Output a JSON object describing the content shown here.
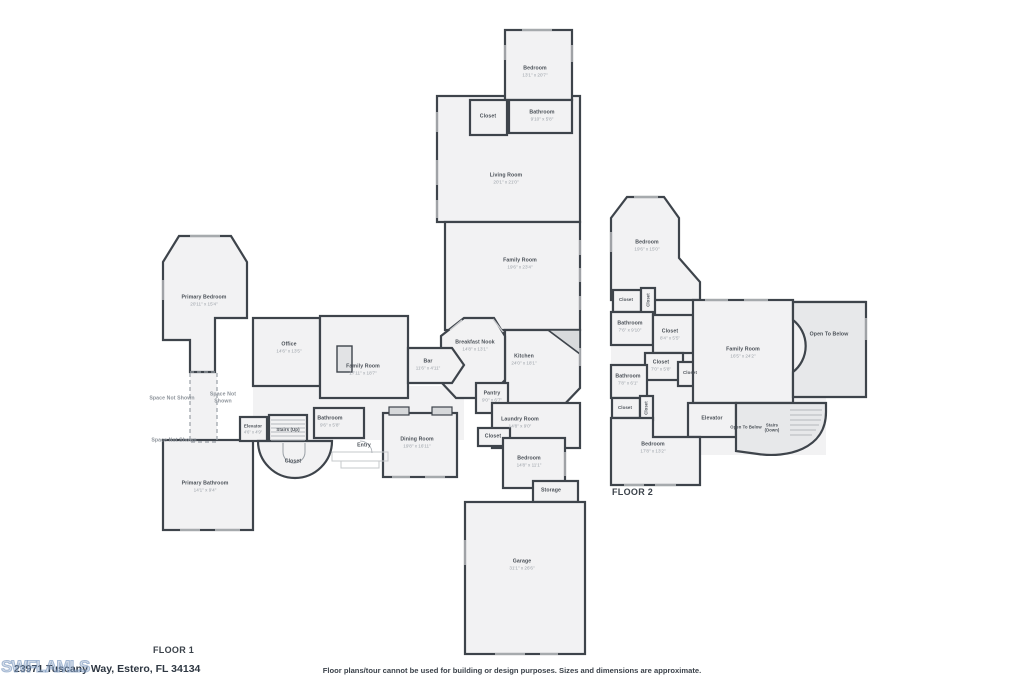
{
  "footer": {
    "address": "23971 Tuscany Way, Estero, FL 34134",
    "disclaimer": "Floor plans/tour cannot be used for building or design purposes. Sizes and dimensions are approximate.",
    "watermark": "SWFLAMLS"
  },
  "colors": {
    "wall": "#3e444b",
    "room_fill": "#f2f2f3",
    "shaded_fill": "#e7e8ea",
    "name_text": "#4a5057",
    "dim_text": "#9ba1a8"
  },
  "floor1": {
    "label": "FLOOR 1",
    "rooms": {
      "bedroom_top": {
        "name": "Bedroom",
        "dims": "13'1\" x 20'7\""
      },
      "closet_top": {
        "name": "Closet"
      },
      "bathroom_top": {
        "name": "Bathroom",
        "dims": "9'10\" x 5'8\""
      },
      "living_room": {
        "name": "Living Room",
        "dims": "20'1\" x 21'0\""
      },
      "family_room": {
        "name": "Family Room",
        "dims": "19'6\" x 23'4\""
      },
      "primary_bedroom": {
        "name": "Primary Bedroom",
        "dims": "20'11\" x 15'4\""
      },
      "office": {
        "name": "Office",
        "dims": "14'6\" x 13'5\""
      },
      "family_room_left": {
        "name": "Family Room",
        "dims": "17'11\" x 18'7\""
      },
      "bar": {
        "name": "Bar",
        "dims": "11'6\" x 4'11\""
      },
      "breakfast_nook": {
        "name": "Breakfast Nook",
        "dims": "14'8\" x 13'1\""
      },
      "kitchen": {
        "name": "Kitchen",
        "dims": "24'0\" x 18'1\""
      },
      "pantry": {
        "name": "Pantry",
        "dims": "9'0\" x 6'7\""
      },
      "laundry_room": {
        "name": "Laundry Room",
        "dims": "14'8\" x 9'0\""
      },
      "closet_hall": {
        "name": "Closet"
      },
      "bedroom_guest": {
        "name": "Bedroom",
        "dims": "14'8\" x 11'1\""
      },
      "storage": {
        "name": "Storage"
      },
      "garage": {
        "name": "Garage",
        "dims": "31'1\" x 26'6\""
      },
      "dining_room": {
        "name": "Dining Room",
        "dims": "19'8\" x 16'11\""
      },
      "bathroom_hall": {
        "name": "Bathroom",
        "dims": "9'6\" x 5'8\""
      },
      "entry": {
        "name": "Entry"
      },
      "elevator": {
        "name": "Elevator",
        "dims": "4'6\" x 4'9\""
      },
      "stairs_up": {
        "name": "Stairs (Up)"
      },
      "closet_stairs": {
        "name": "Closet"
      },
      "space_not_shown_a": {
        "name": "Space Not Shown"
      },
      "space_not_shown_b": {
        "name": "Space Not Shown"
      },
      "space_not_shown_c": {
        "name": "Space Not Shown"
      },
      "primary_bathroom": {
        "name": "Primary Bathroom",
        "dims": "14'1\" x 9'4\""
      }
    }
  },
  "floor2": {
    "label": "FLOOR 2",
    "rooms": {
      "bedroom": {
        "name": "Bedroom",
        "dims": "19'6\" x 15'0\""
      },
      "closet_a": {
        "name": "Closet"
      },
      "closet_a_v": {
        "name": "Closet"
      },
      "bathroom_a": {
        "name": "Bathroom",
        "dims": "7'6\" x 9'10\""
      },
      "closet_b": {
        "name": "Closet",
        "dims": "8'4\" x 5'5\""
      },
      "closet_c": {
        "name": "Closet",
        "dims": "7'0\" x 5'8\""
      },
      "closet_small": {
        "name": "Closet"
      },
      "bathroom_b": {
        "name": "Bathroom",
        "dims": "7'8\" x 6'1\""
      },
      "closet_d": {
        "name": "Closet"
      },
      "closet_d_v": {
        "name": "Closet"
      },
      "family_room": {
        "name": "Family Room",
        "dims": "16'5\" x 24'2\""
      },
      "open_to_below_large": {
        "name": "Open To Below"
      },
      "elevator": {
        "name": "Elevator"
      },
      "open_to_below_small": {
        "name": "Open To Below"
      },
      "stairs_down": {
        "name": "Stairs (Down)"
      },
      "bedroom_b": {
        "name": "Bedroom",
        "dims": "17'8\" x 13'2\""
      }
    }
  }
}
